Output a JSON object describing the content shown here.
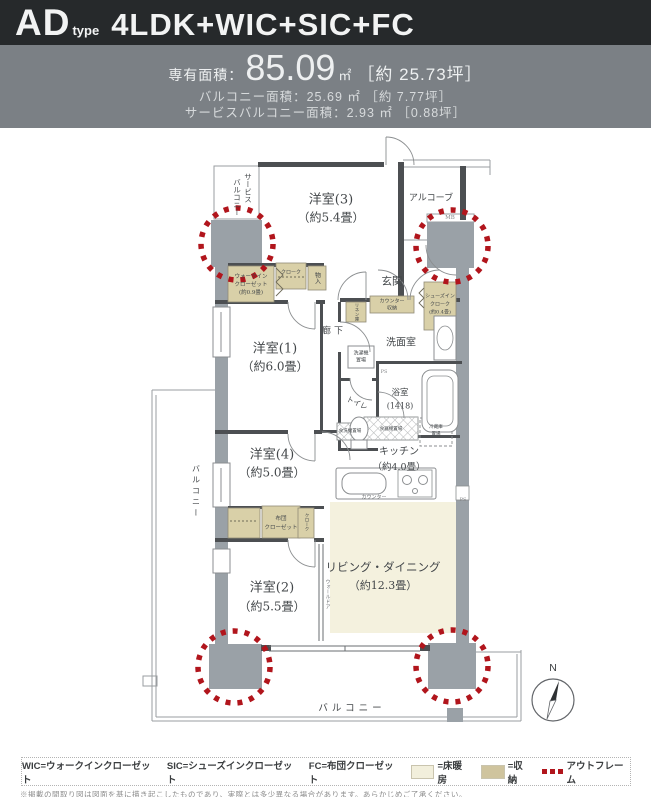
{
  "header": {
    "brand": "AD",
    "brand_sub": "type",
    "plan_type": "4LDK+WIC+SIC+FC"
  },
  "areas": {
    "label": "専有面積：",
    "value": "85.09",
    "unit": "㎡",
    "tsubo": "［約 25.73坪］",
    "balcony_line": "バルコニー面積：25.69 ㎡ ［約 7.77坪］",
    "service_balcony_line": "サービスバルコニー面積：2.93 ㎡ ［0.88坪］"
  },
  "rooms": {
    "western3": {
      "name": "洋室(3)",
      "size": "（約5.4畳）"
    },
    "alcove": "アルコーブ",
    "mb": "MB",
    "entrance": "玄関",
    "sic": {
      "l1": "シューズイン",
      "l2": "クローク",
      "l3": "(約0.4畳)"
    },
    "wic": {
      "l1": "ウォークイン",
      "l2": "クローゼット",
      "l3": "(約0.9畳)"
    },
    "cloak": "クローク",
    "storage_small": "物入",
    "western1": {
      "name": "洋室(1)",
      "size": "（約6.0畳）"
    },
    "hallway": "廊下",
    "linen": "リネン庫",
    "counter_storage": {
      "l1": "カウンター",
      "l2": "収納"
    },
    "powder_room": "洗面室",
    "washer": {
      "l1": "洗濯機",
      "l2": "置場"
    },
    "bathroom": {
      "l1": "浴室",
      "l2": "(1418)"
    },
    "toilet": "トイレ",
    "ps": "PS",
    "western4": {
      "name": "洋室(4)",
      "size": "（約5.0畳）"
    },
    "futon_closet": {
      "l1": "布団",
      "l2": "クローゼット"
    },
    "cloak2": "クローク",
    "western2": {
      "name": "洋室(2)",
      "size": "（約5.5畳）"
    },
    "wall_door": "ウォールドア",
    "kitchen": {
      "name": "キッチン",
      "size": "（約4.0畳）"
    },
    "dishwasher": "食洗機置場",
    "cupboard": "食器棚置場",
    "fridge": {
      "l1": "冷蔵庫",
      "l2": "置場"
    },
    "counter": "カウンター",
    "living": {
      "name": "リビング・ダイニング",
      "size": "（約12.3畳）"
    },
    "balcony_bottom": "バルコニー",
    "balcony_left": "バルコニー",
    "service_balcony": {
      "c1": "サービス",
      "c2": "バルコニー"
    },
    "north": "N"
  },
  "legend": {
    "wic": "WIC=ウォークインクローゼット",
    "sic": "SIC=シューズインクローゼット",
    "fc": "FC=布団クローゼット",
    "heating": "=床暖房",
    "storage": "=収納",
    "outframe": "アウトフレーム"
  },
  "note": "※掲載の間取り図は図面を基に描き起こしたものであり、実際とは多少異なる場合があります。あらかじめご了承ください。",
  "colors": {
    "accent_red": "#b1151c",
    "pillar_gray": "#9aa1a7",
    "storage_beige": "#d9d0a8",
    "floor_heating": "#f4f1de",
    "header_black": "#26292b",
    "header_gray": "#7b8085"
  }
}
